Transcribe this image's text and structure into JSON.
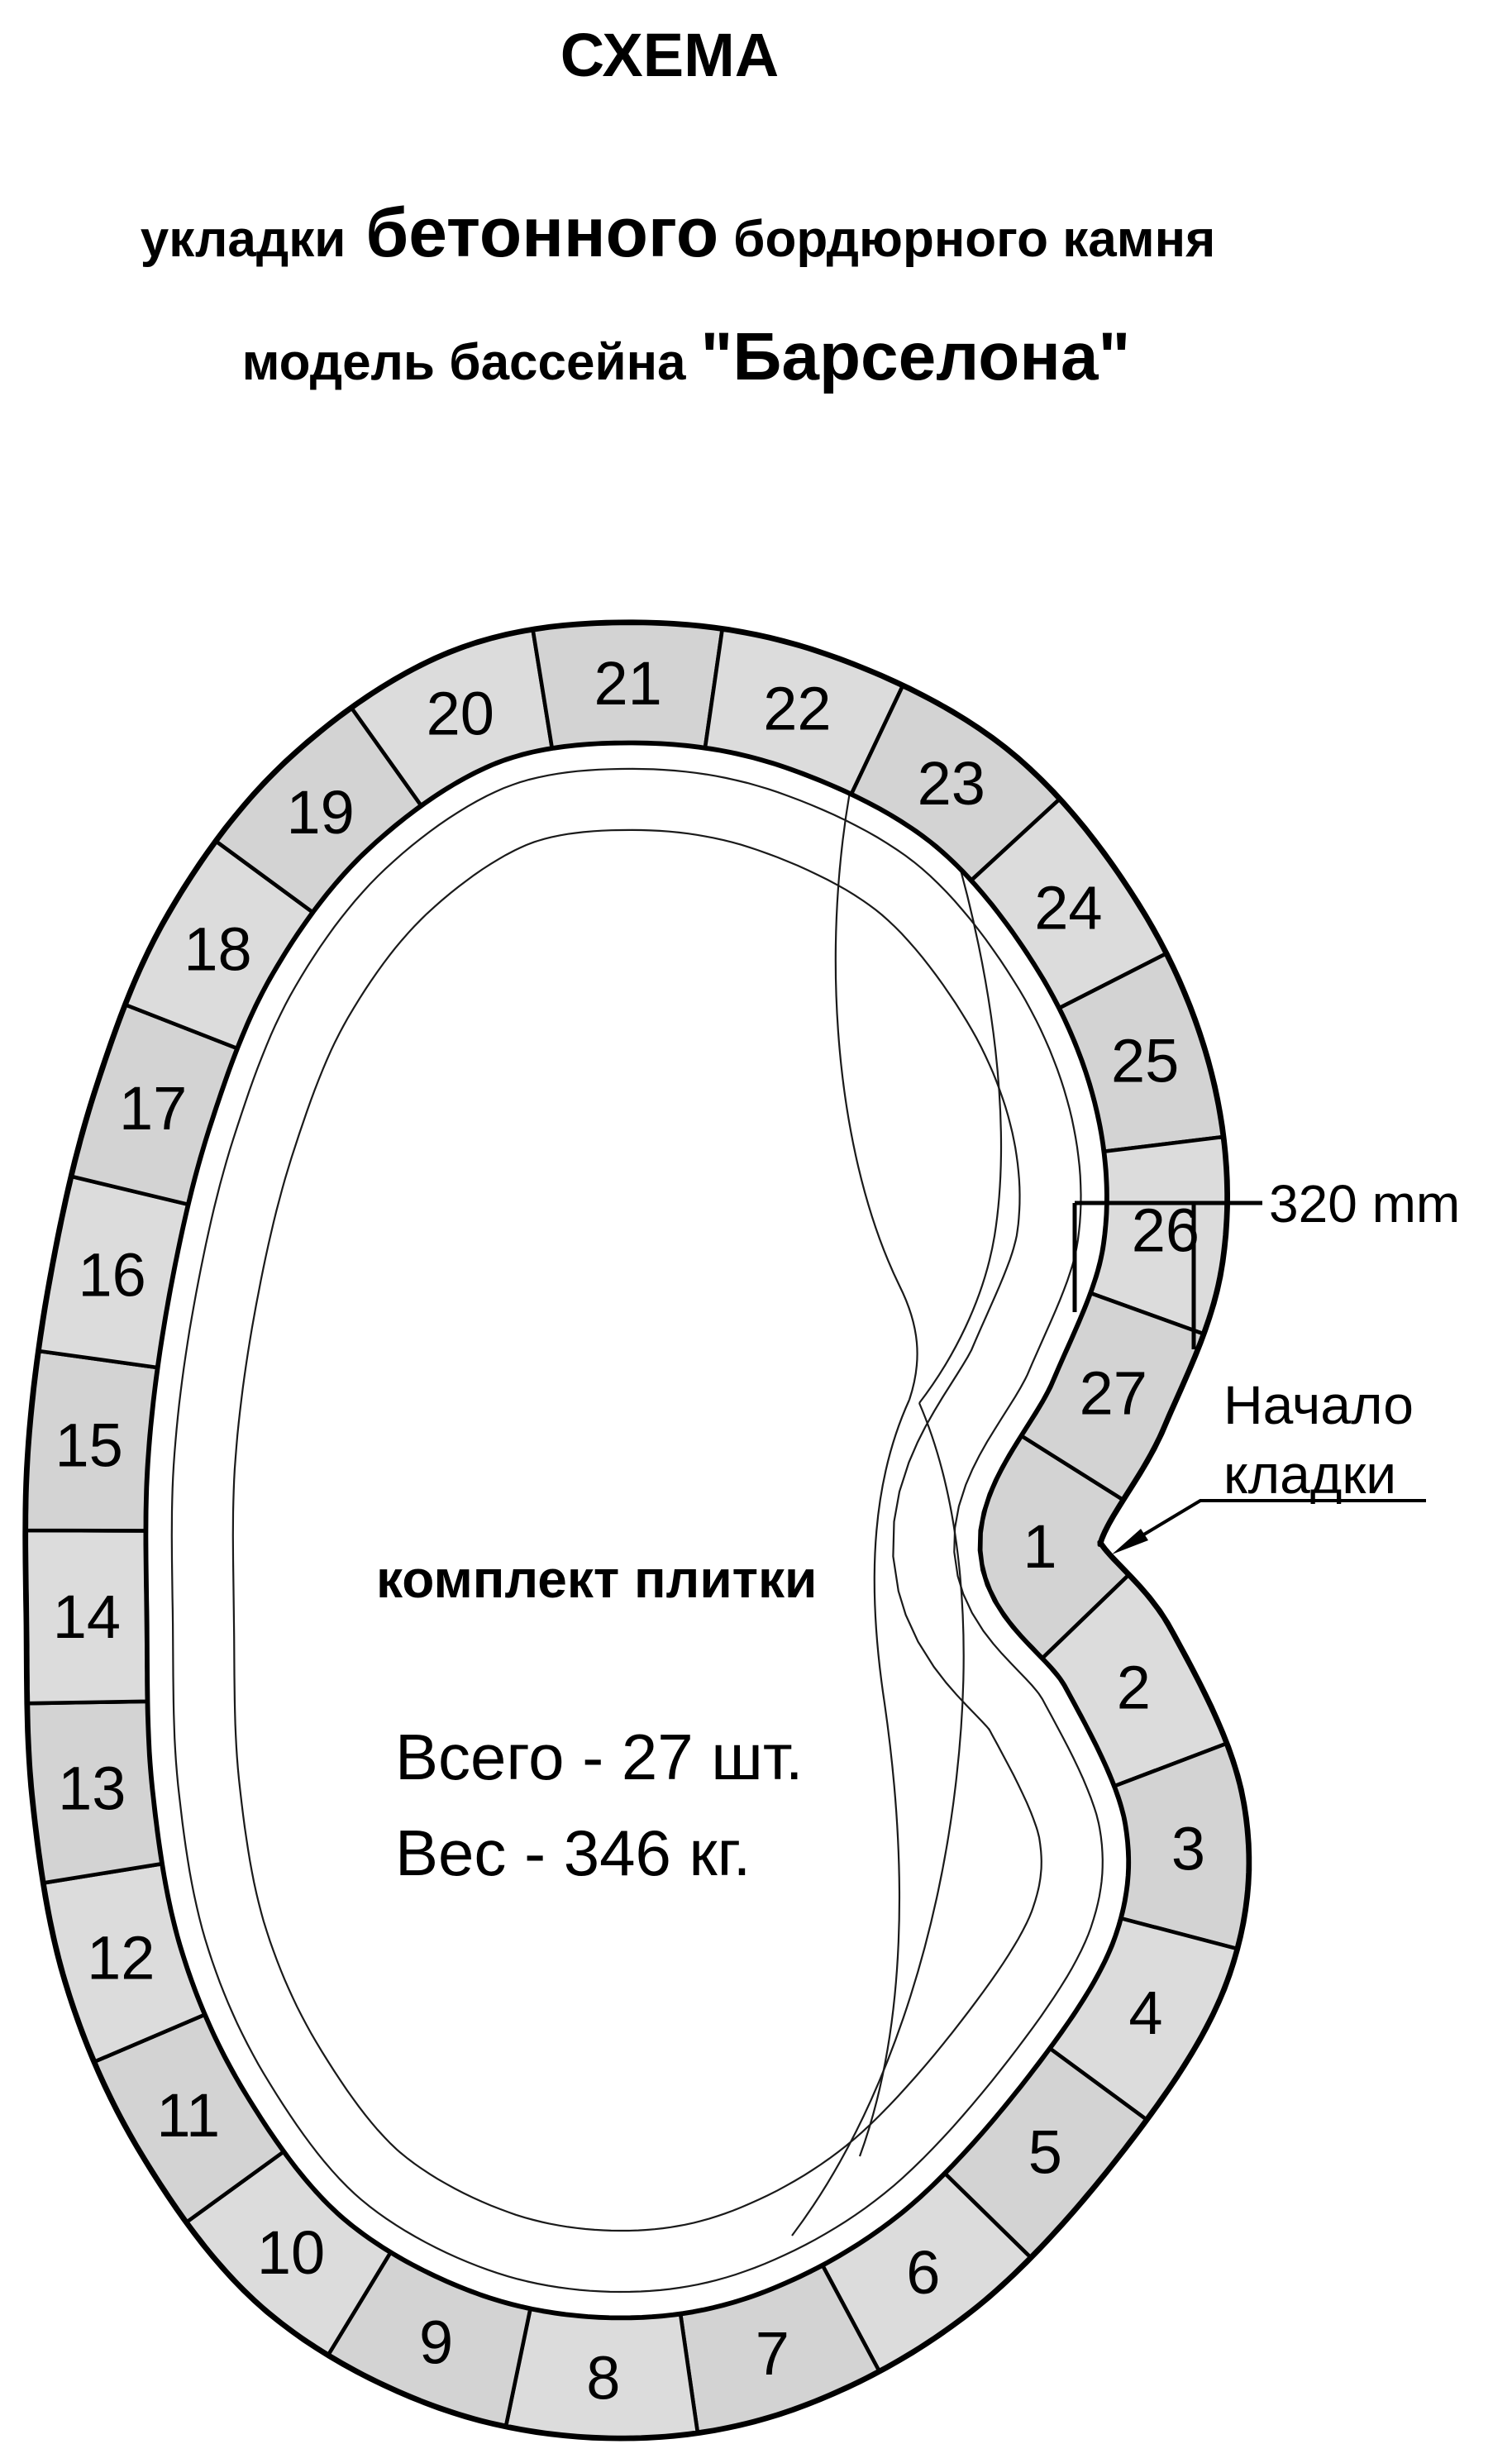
{
  "header": {
    "title": "СХЕМА",
    "line2_pre": "укладки",
    "line2_em": "бетонного",
    "line2_post": "бордюрного камня",
    "line3_pre": "модель бассейна",
    "line3_em": "\"Барселона\""
  },
  "kit": {
    "heading": "комплект плитки",
    "total_line": "Всего - 27 шт.",
    "weight_line": "Вес - 346 кг."
  },
  "annotations": {
    "tile_width": "320 mm",
    "start_label_line1": "Начало",
    "start_label_line2": "кладки"
  },
  "tiles": {
    "count": 27,
    "labels": [
      "1",
      "2",
      "3",
      "4",
      "5",
      "6",
      "7",
      "8",
      "9",
      "10",
      "11",
      "12",
      "13",
      "14",
      "15",
      "16",
      "17",
      "18",
      "19",
      "20",
      "21",
      "22",
      "23",
      "24",
      "25",
      "26",
      "27"
    ]
  },
  "colors": {
    "background": "#ffffff",
    "tile_fill": "#d3d3d3",
    "tile_fill_alt": "#dcdcdc",
    "outline": "#000000",
    "text": "#000000"
  }
}
